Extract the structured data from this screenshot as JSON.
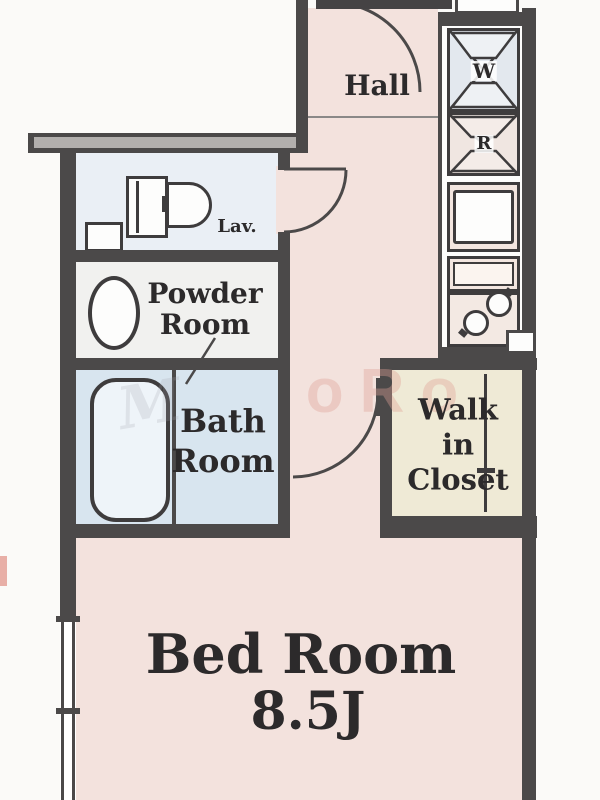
{
  "rooms": {
    "hall": {
      "label": "Hall"
    },
    "lavatory": {
      "label": "Lav."
    },
    "powder_room": {
      "line1": "Powder",
      "line2": "Room"
    },
    "bath_room": {
      "line1": "Bath",
      "line2": "Room"
    },
    "walk_in_closet": {
      "line1": "Walk",
      "line2": "in",
      "line3": "Closet"
    },
    "bed_room": {
      "label": "Bed Room",
      "size": "8.5J"
    }
  },
  "fixtures": {
    "washing_machine_symbol": "W",
    "refrigerator_symbol": "R"
  },
  "watermark": {
    "fragment": "oRo",
    "script_fragment": "M"
  },
  "colors": {
    "wall": "#4b4949",
    "room_pink": "#f3e2dd",
    "bath_blue": "#d8e5ef",
    "lav_blue": "#eaeff5",
    "powder_gray": "#f1f1ef",
    "closet_cream": "#efead6",
    "washer_cell_blue": "#e3e8ee",
    "watermark_pink": "#e0a096"
  }
}
